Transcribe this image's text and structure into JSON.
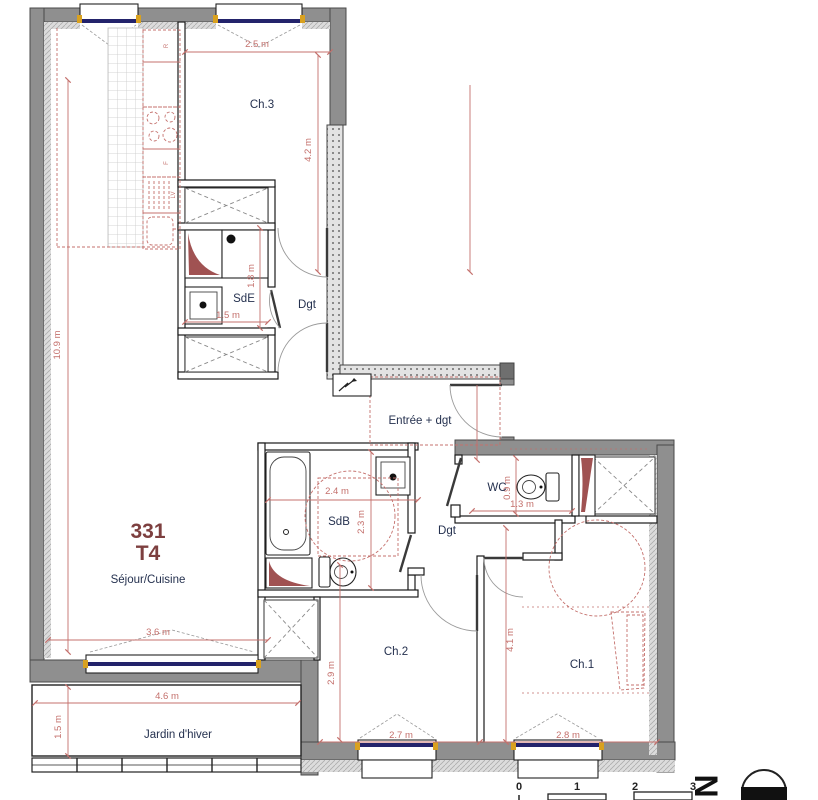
{
  "unit": {
    "number": "331",
    "type": "T4"
  },
  "labels": {
    "ch3": "Ch.3",
    "sde": "SdE",
    "dgt_upper": "Dgt",
    "entree": "Entrée + dgt",
    "wc": "WC",
    "sdb": "SdB",
    "dgt_lower": "Dgt",
    "sejour": "Séjour/Cuisine",
    "ch2": "Ch.2",
    "ch1": "Ch.1",
    "jardin": "Jardin d'hiver"
  },
  "dimensions": {
    "ch3_w": "2.5 m",
    "ch3_h": "4.2 m",
    "sejour_h": "10.9 m",
    "sde_h": "1.8 m",
    "sde_w": "1.5 m",
    "sdb_w": "2.4 m",
    "sdb_h": "2.3 m",
    "wc_h": "0.9 m",
    "wc_w": "1.3 m",
    "sejour_w": "3.6 m",
    "jardin_w": "4.6 m",
    "jardin_h": "1.5 m",
    "ch2_h": "2.9 m",
    "ch2_w": "2.7 m",
    "ch1_h": "4.1 m",
    "ch1_w": "2.8 m"
  },
  "kitchen_units": {
    "fridge": "R",
    "oven": "F",
    "dishwasher": "LV"
  },
  "scale_bar": {
    "ticks": [
      "0",
      "1",
      "2",
      "3"
    ]
  },
  "compass": {
    "north": "N"
  },
  "colors": {
    "wall_gray": "#8f8f8f",
    "dim_red": "#c4706c",
    "accent_maroon": "#7d3f3f",
    "label_navy": "#25314f",
    "glazing_navy": "#23236b",
    "jamb_yellow": "#d9a11f",
    "duct_maroon": "#a05252"
  }
}
